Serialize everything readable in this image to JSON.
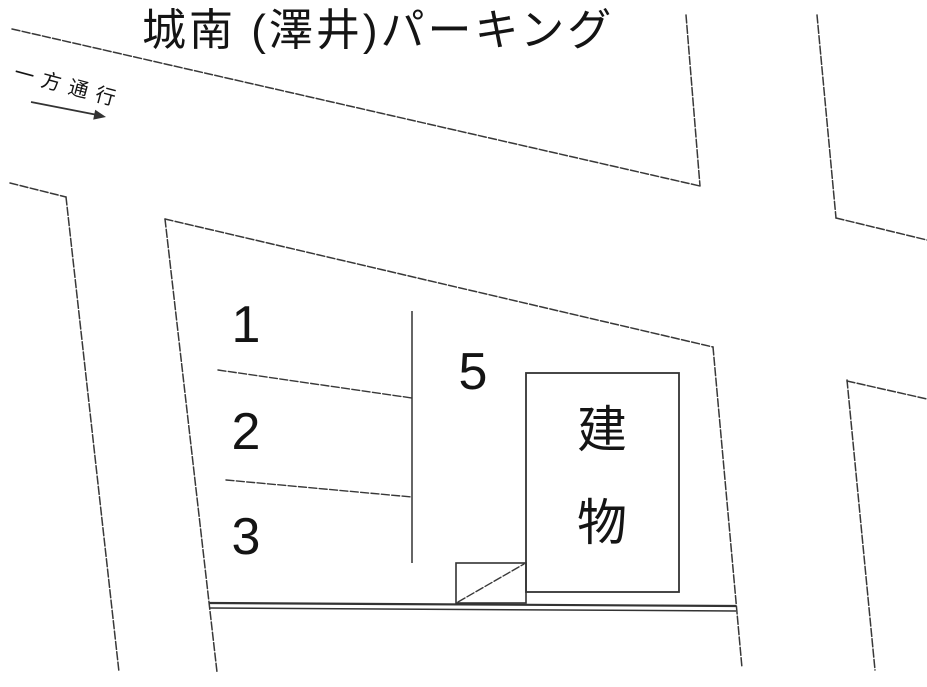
{
  "title": "城南 (澤井)パーキング",
  "one_way": {
    "label": "一方通行",
    "direction": "down-right"
  },
  "parking": {
    "spaces": [
      {
        "number": "1"
      },
      {
        "number": "2"
      },
      {
        "number": "3"
      },
      {
        "number": "5"
      }
    ]
  },
  "building": {
    "label": "建物",
    "label_lines": [
      "建",
      "物"
    ]
  },
  "colors": {
    "ink": "#333333",
    "background": "#ffffff"
  }
}
